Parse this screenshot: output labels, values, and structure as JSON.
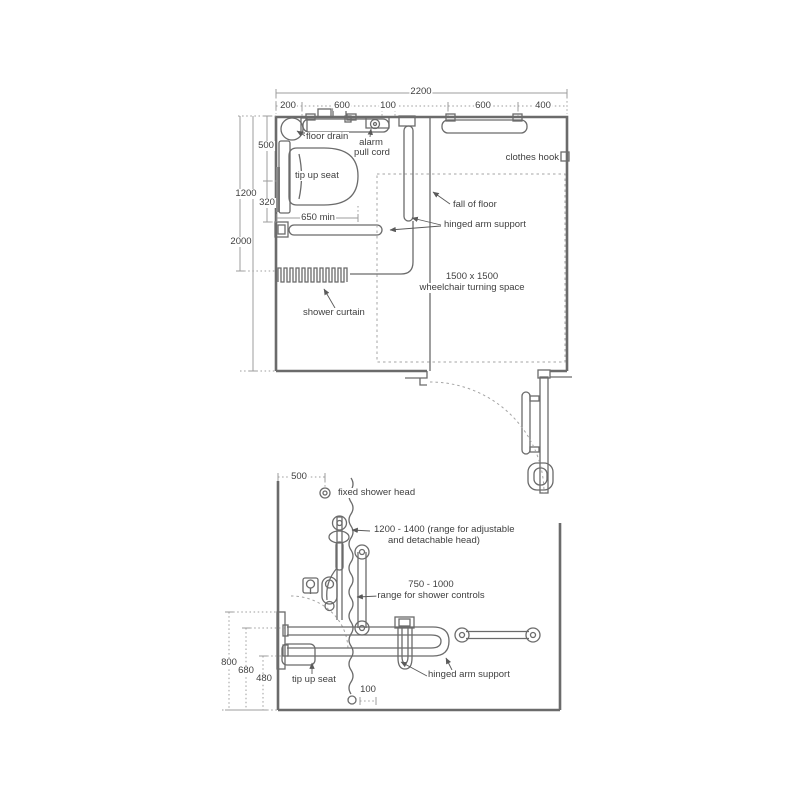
{
  "plan": {
    "dim_2200": "2200",
    "seg_200": "200",
    "seg_600a": "600",
    "seg_100": "100",
    "seg_600b": "600",
    "seg_400": "400",
    "dim_500": "500",
    "dim_1200": "1200",
    "dim_320": "320",
    "dim_2000": "2000",
    "dim_650": "650 min",
    "floor_drain": "floor drain",
    "alarm_1": "alarm",
    "alarm_2": "pull cord",
    "tip_up_seat": "tip up seat",
    "clothes_hook": "clothes hook",
    "fall_of_floor": "fall of floor",
    "hinged_arm_support": "hinged arm support",
    "turning_1": "1500 x 1500",
    "turning_2": "wheelchair turning space",
    "shower_curtain": "shower curtain"
  },
  "elevation": {
    "dim_500": "500",
    "fixed_shower_head": "fixed shower head",
    "range_head_1": "1200 - 1400 (range for adjustable",
    "range_head_2": "and detachable head)",
    "range_controls_1": "750 - 1000",
    "range_controls_2": "range for shower controls",
    "dim_800": "800",
    "dim_680": "680",
    "dim_480": "480",
    "dim_100": "100",
    "tip_up_seat": "tip up seat",
    "hinged_arm_support": "hinged arm support"
  },
  "colors": {
    "line": "#6b6b6b",
    "dim": "#9c9c9c",
    "text": "#3f3f3f",
    "background": "#ffffff"
  }
}
